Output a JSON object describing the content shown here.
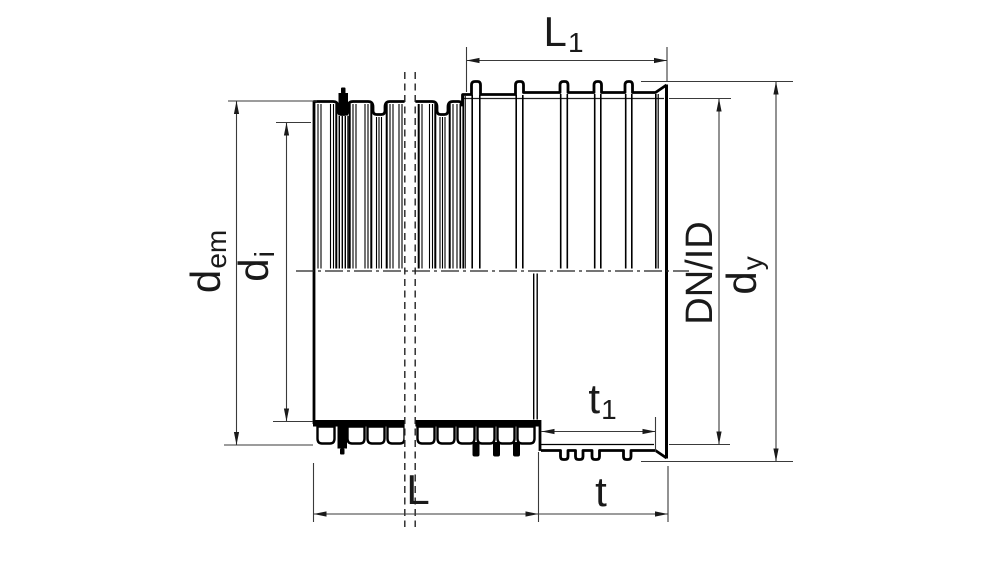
{
  "drawing": {
    "description": "Longitudinal half-section technical drawing of a corrugated twin-wall pipe with integrated ribbed socket, sealing ring and dimension annotations",
    "background_color": "#ffffff",
    "outline_color": "#000000",
    "dimension_line_color": "#3a3a3a",
    "labels": {
      "l1": {
        "main": "L",
        "sub": "1"
      },
      "dem": {
        "main": "d",
        "sub": "em"
      },
      "di": {
        "main": "d",
        "sub": "i"
      },
      "dnid": {
        "main": "DN/ID",
        "sub": ""
      },
      "dy": {
        "main": "d",
        "sub": "y"
      },
      "t1": {
        "main": "t",
        "sub": "1"
      },
      "l": {
        "main": "L",
        "sub": ""
      },
      "t": {
        "main": "t",
        "sub": ""
      }
    }
  }
}
